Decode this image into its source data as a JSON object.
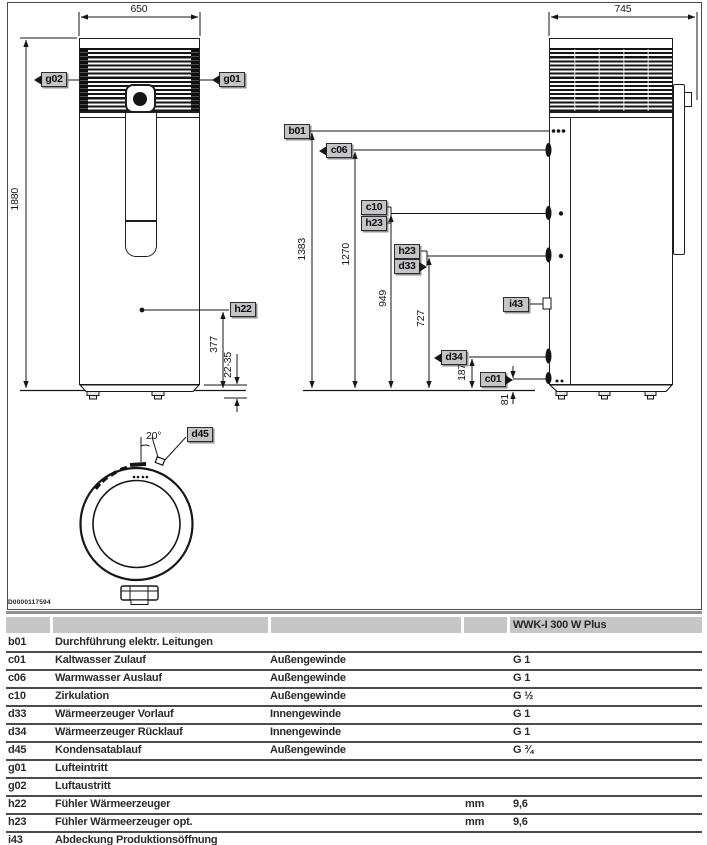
{
  "figure": {
    "drawing_number": "D0000117594",
    "front_view": {
      "dim_width": "650",
      "dim_height": "1880",
      "dim_sensor_height": "377",
      "dim_feet_range": "22-35",
      "labels": {
        "g02": "g02",
        "g01": "g01",
        "h22": "h22"
      }
    },
    "side_view": {
      "dim_depth": "745",
      "dim_b01": "1383",
      "dim_c06": "1270",
      "dim_c10": "949",
      "dim_d33": "727",
      "dim_d34": "187",
      "dim_c01": "81",
      "labels": {
        "b01": "b01",
        "c06": "c06",
        "c10": "c10",
        "h23_upper": "h23",
        "h23_lower": "h23",
        "d33": "d33",
        "i43": "i43",
        "d34": "d34",
        "c01": "c01"
      }
    },
    "top_view": {
      "angle": "20°",
      "labels": {
        "d45": "d45"
      }
    }
  },
  "table": {
    "model_header": "WWK-I 300 W Plus",
    "rows": [
      {
        "key": "b01",
        "desc": "Durchführung elektr. Leitungen",
        "thread": "",
        "unit": "",
        "value": ""
      },
      {
        "key": "c01",
        "desc": "Kaltwasser Zulauf",
        "thread": "Außengewinde",
        "unit": "",
        "value": "G 1"
      },
      {
        "key": "c06",
        "desc": "Warmwasser Auslauf",
        "thread": "Außengewinde",
        "unit": "",
        "value": "G 1"
      },
      {
        "key": "c10",
        "desc": "Zirkulation",
        "thread": "Außengewinde",
        "unit": "",
        "value": "G ½"
      },
      {
        "key": "d33",
        "desc": "Wärmeerzeuger Vorlauf",
        "thread": "Innengewinde",
        "unit": "",
        "value": "G 1"
      },
      {
        "key": "d34",
        "desc": "Wärmeerzeuger Rücklauf",
        "thread": "Innengewinde",
        "unit": "",
        "value": "G 1"
      },
      {
        "key": "d45",
        "desc": "Kondensatablauf",
        "thread": "Außengewinde",
        "unit": "",
        "value": "G ¾"
      },
      {
        "key": "g01",
        "desc": "Lufteintritt",
        "thread": "",
        "unit": "",
        "value": ""
      },
      {
        "key": "g02",
        "desc": "Luftaustritt",
        "thread": "",
        "unit": "",
        "value": ""
      },
      {
        "key": "h22",
        "desc": "Fühler Wärmeerzeuger",
        "thread": "",
        "unit": "mm",
        "value": "9,6"
      },
      {
        "key": "h23",
        "desc": "Fühler Wärmeerzeuger opt.",
        "thread": "",
        "unit": "mm",
        "value": "9,6"
      },
      {
        "key": "i43",
        "desc": "Abdeckung Produktionsöffnung",
        "thread": "",
        "unit": "",
        "value": ""
      }
    ]
  }
}
